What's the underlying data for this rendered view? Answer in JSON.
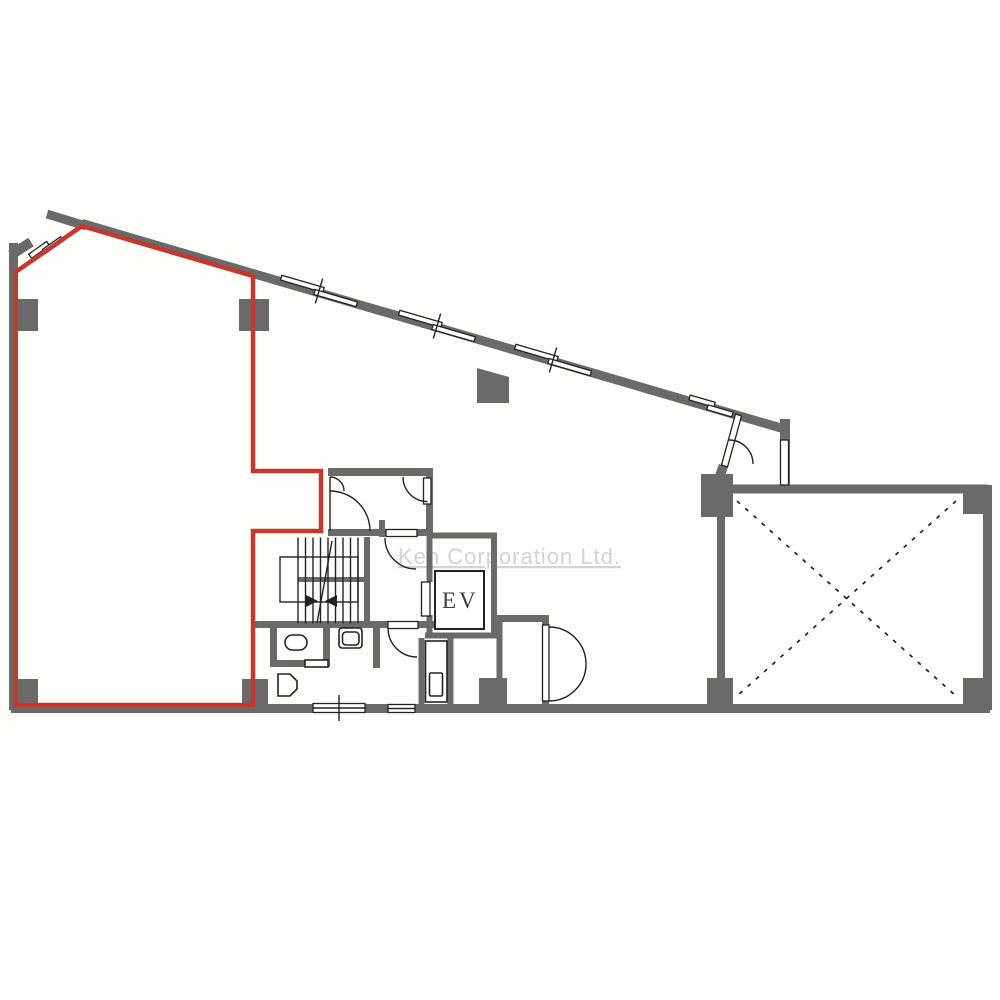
{
  "watermark": {
    "text": "Ken Corporation Ltd."
  },
  "labels": {
    "elevator": "EV"
  },
  "colors": {
    "wall": "#6a6a6a",
    "line": "#232323",
    "highlight": "#c5382f",
    "watermark": "#d3d3d3",
    "background": "#fdfdf9",
    "label": "#3d3d3d"
  }
}
